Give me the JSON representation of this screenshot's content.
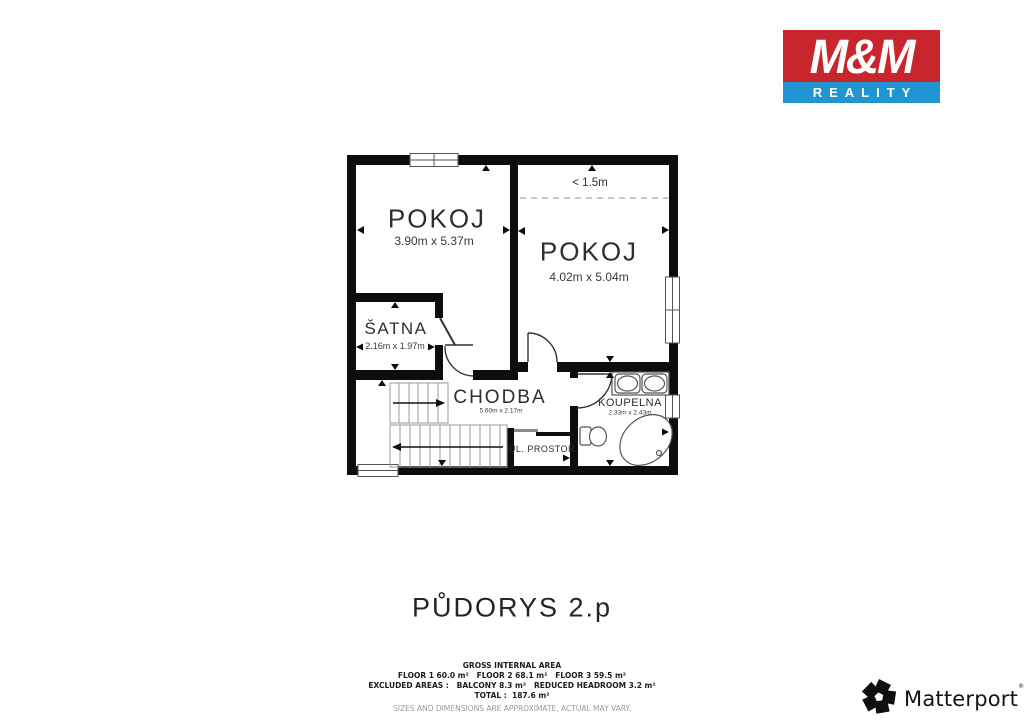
{
  "brand_logo": {
    "title": "M&M",
    "subtitle": "REALITY",
    "red": "#c9252c",
    "blue": "#2095d2"
  },
  "floorplan": {
    "annotation_headroom": "< 1.5m",
    "rooms": [
      {
        "name": "POKOJ",
        "dims": "3.90m x 5.37m"
      },
      {
        "name": "POKOJ",
        "dims": "4.02m x 5.04m"
      },
      {
        "name": "ŠATNA",
        "dims": "2.16m x 1.97m"
      },
      {
        "name": "CHODBA",
        "dims": "5.60m x 2.17m"
      },
      {
        "name": "KOUPELNA",
        "dims": "2.33m x 2.43m"
      },
      {
        "name": "ÚL. PROSTOR",
        "dims": ""
      }
    ]
  },
  "title": "PŮDORYS 2.p",
  "area_summary": {
    "heading": "GROSS INTERNAL AREA",
    "floors": "FLOOR 1 60.0 m²   FLOOR 2 68.1 m²   FLOOR 3 59.5 m²",
    "excluded": "EXCLUDED AREAS :   BALCONY 8.3 m²   REDUCED HEADROOM 3.2 m²",
    "total": "TOTAL :  187.6 m²",
    "disclaimer": "SIZES AND DIMENSIONS ARE APPROXIMATE, ACTUAL MAY VARY."
  },
  "matterport": {
    "name": "Matterport",
    "mark": "®"
  }
}
